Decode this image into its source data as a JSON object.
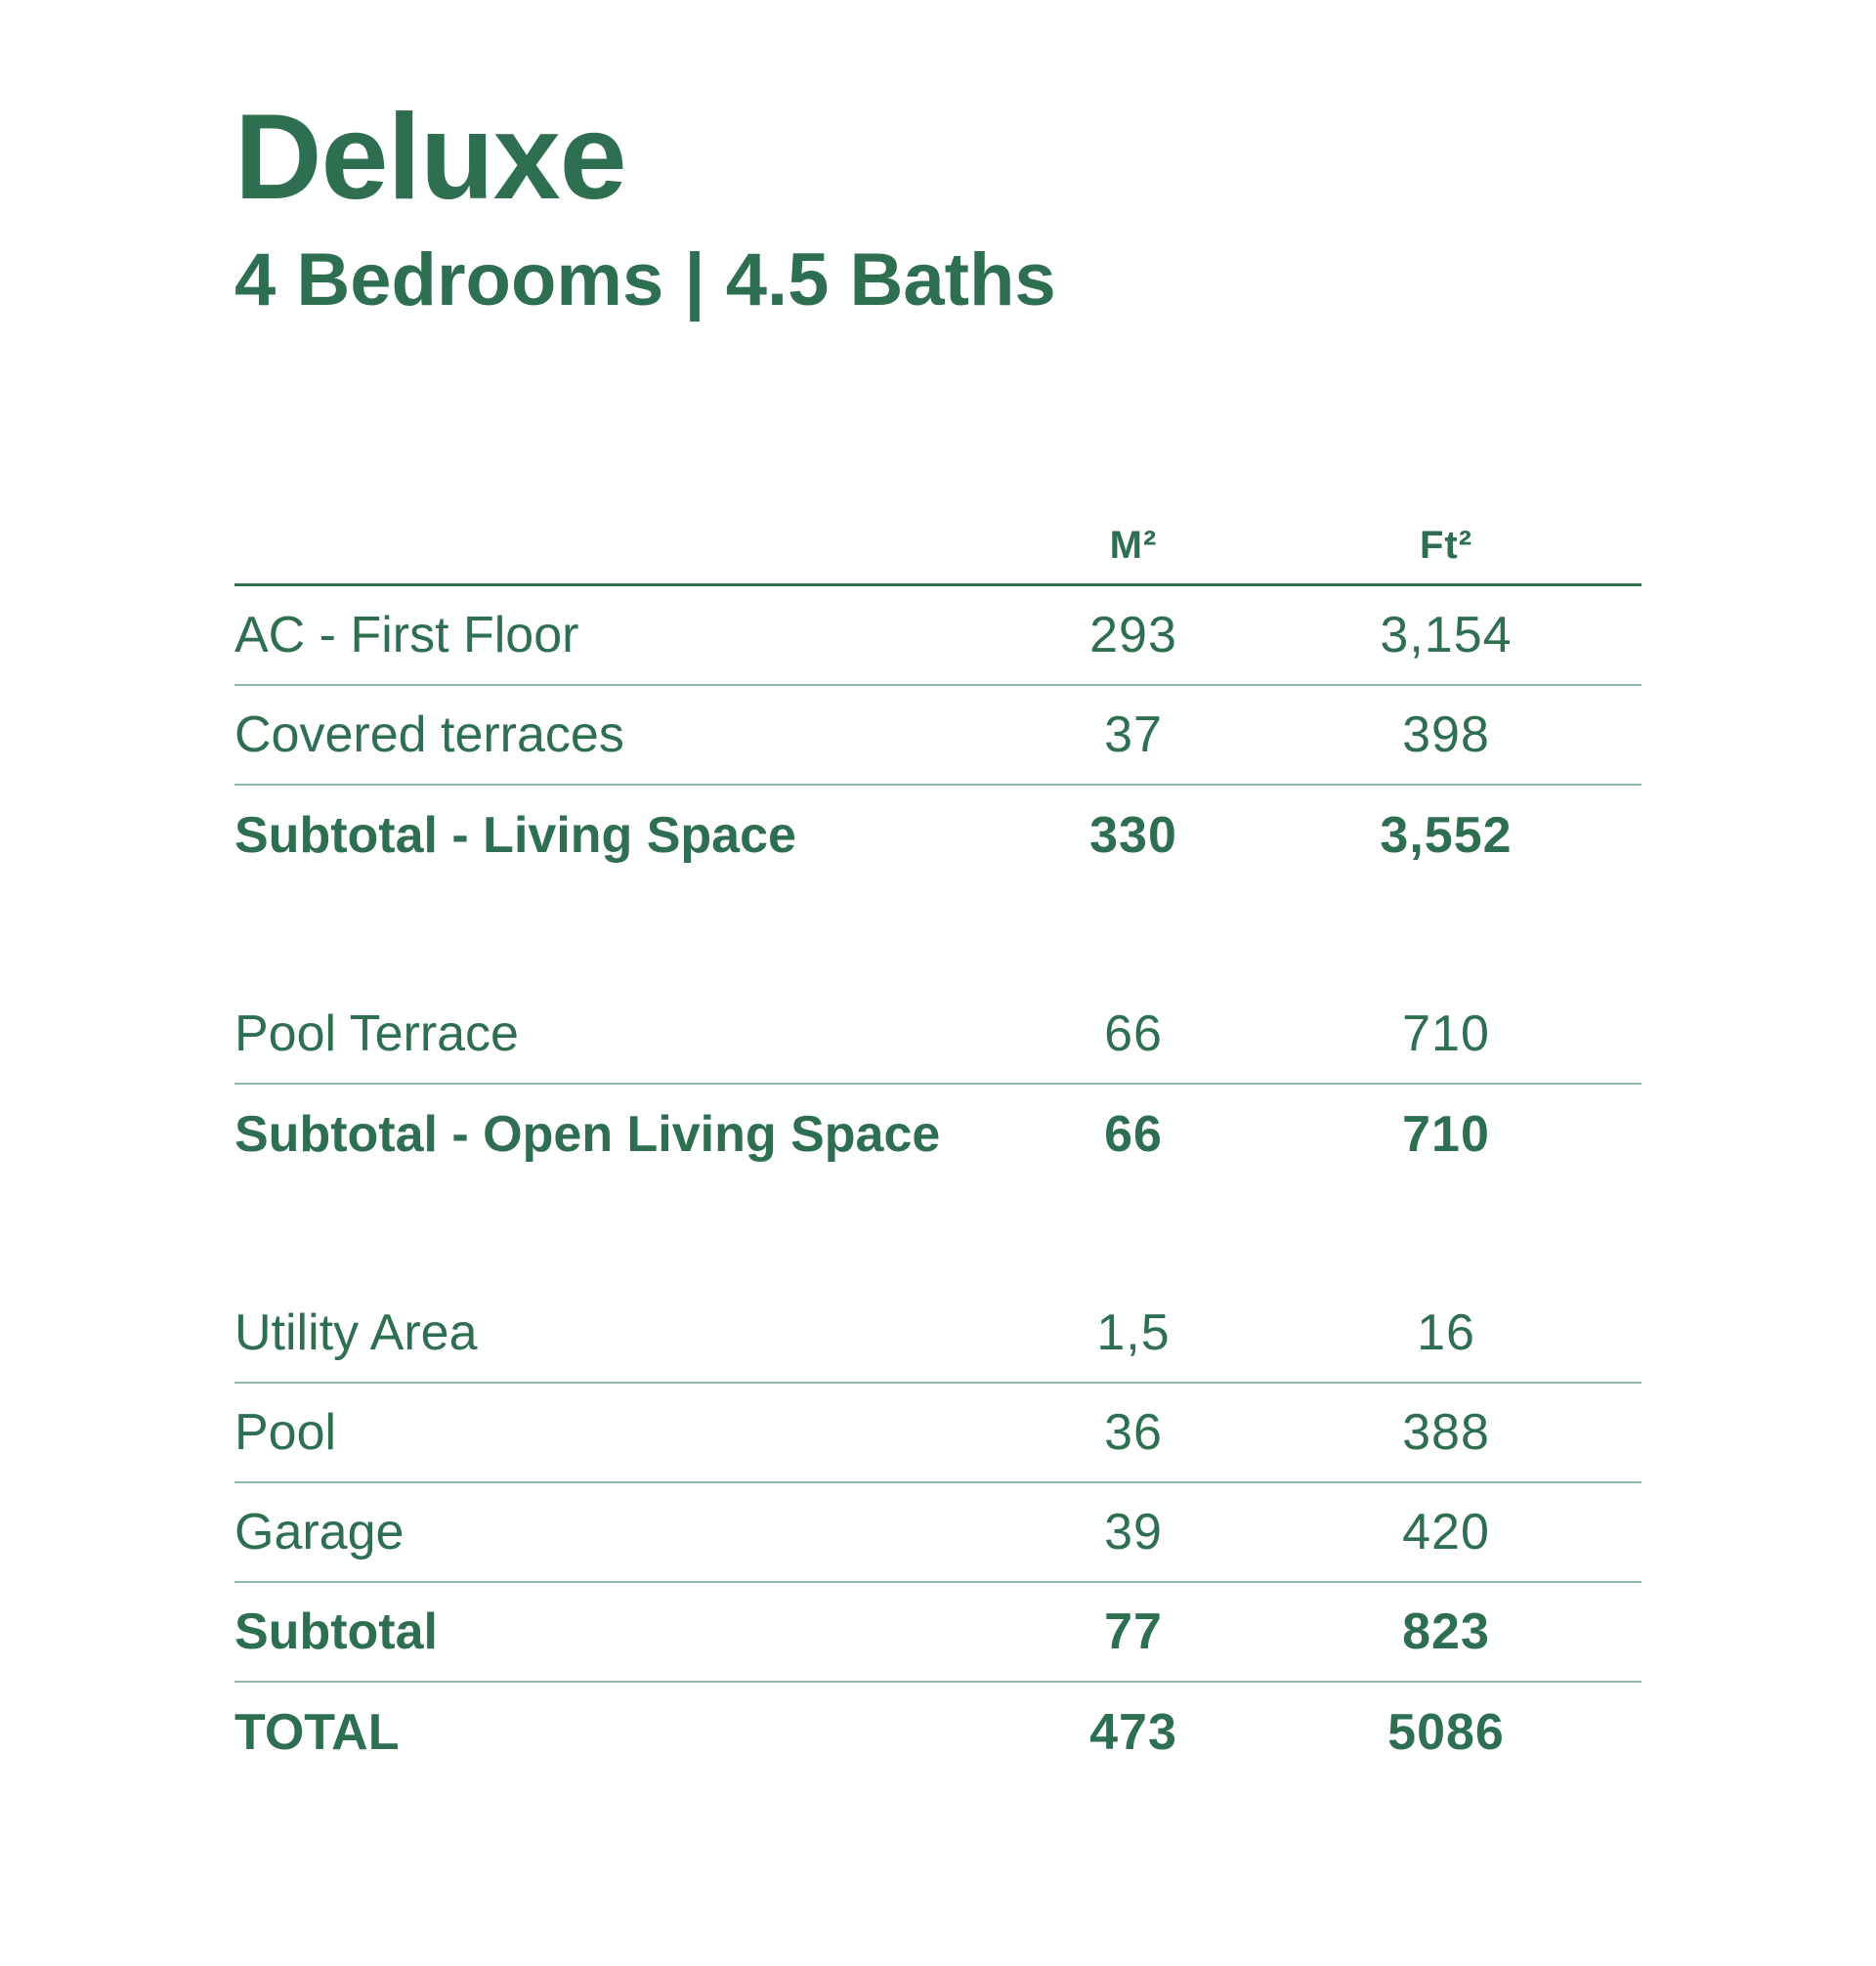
{
  "accent_color": "#2E6E51",
  "header": {
    "title": "Deluxe",
    "subtitle": "4 Bedrooms | 4.5 Baths"
  },
  "table": {
    "column_headers": {
      "m2": "M²",
      "ft2": "Ft²"
    },
    "sections": [
      {
        "name": "living-space",
        "rows": [
          {
            "label": "AC - First Floor",
            "m2": "293",
            "ft2": "3,154",
            "emphasis": false
          },
          {
            "label": "Covered terraces",
            "m2": "37",
            "ft2": "398",
            "emphasis": false
          },
          {
            "label": "Subtotal - Living Space",
            "m2": "330",
            "ft2": "3,552",
            "emphasis": true
          }
        ]
      },
      {
        "name": "open-living-space",
        "rows": [
          {
            "label": "Pool Terrace",
            "m2": "66",
            "ft2": "710",
            "emphasis": false
          },
          {
            "label": "Subtotal - Open Living Space",
            "m2": "66",
            "ft2": "710",
            "emphasis": true
          }
        ]
      },
      {
        "name": "other-areas",
        "rows": [
          {
            "label": "Utility Area",
            "m2": "1,5",
            "ft2": "16",
            "emphasis": false
          },
          {
            "label": "Pool",
            "m2": "36",
            "ft2": "388",
            "emphasis": false
          },
          {
            "label": "Garage",
            "m2": "39",
            "ft2": "420",
            "emphasis": false
          },
          {
            "label": "Subtotal",
            "m2": "77",
            "ft2": "823",
            "emphasis": true
          },
          {
            "label": "TOTAL",
            "m2": "473",
            "ft2": "5086",
            "emphasis": true
          }
        ]
      }
    ]
  }
}
